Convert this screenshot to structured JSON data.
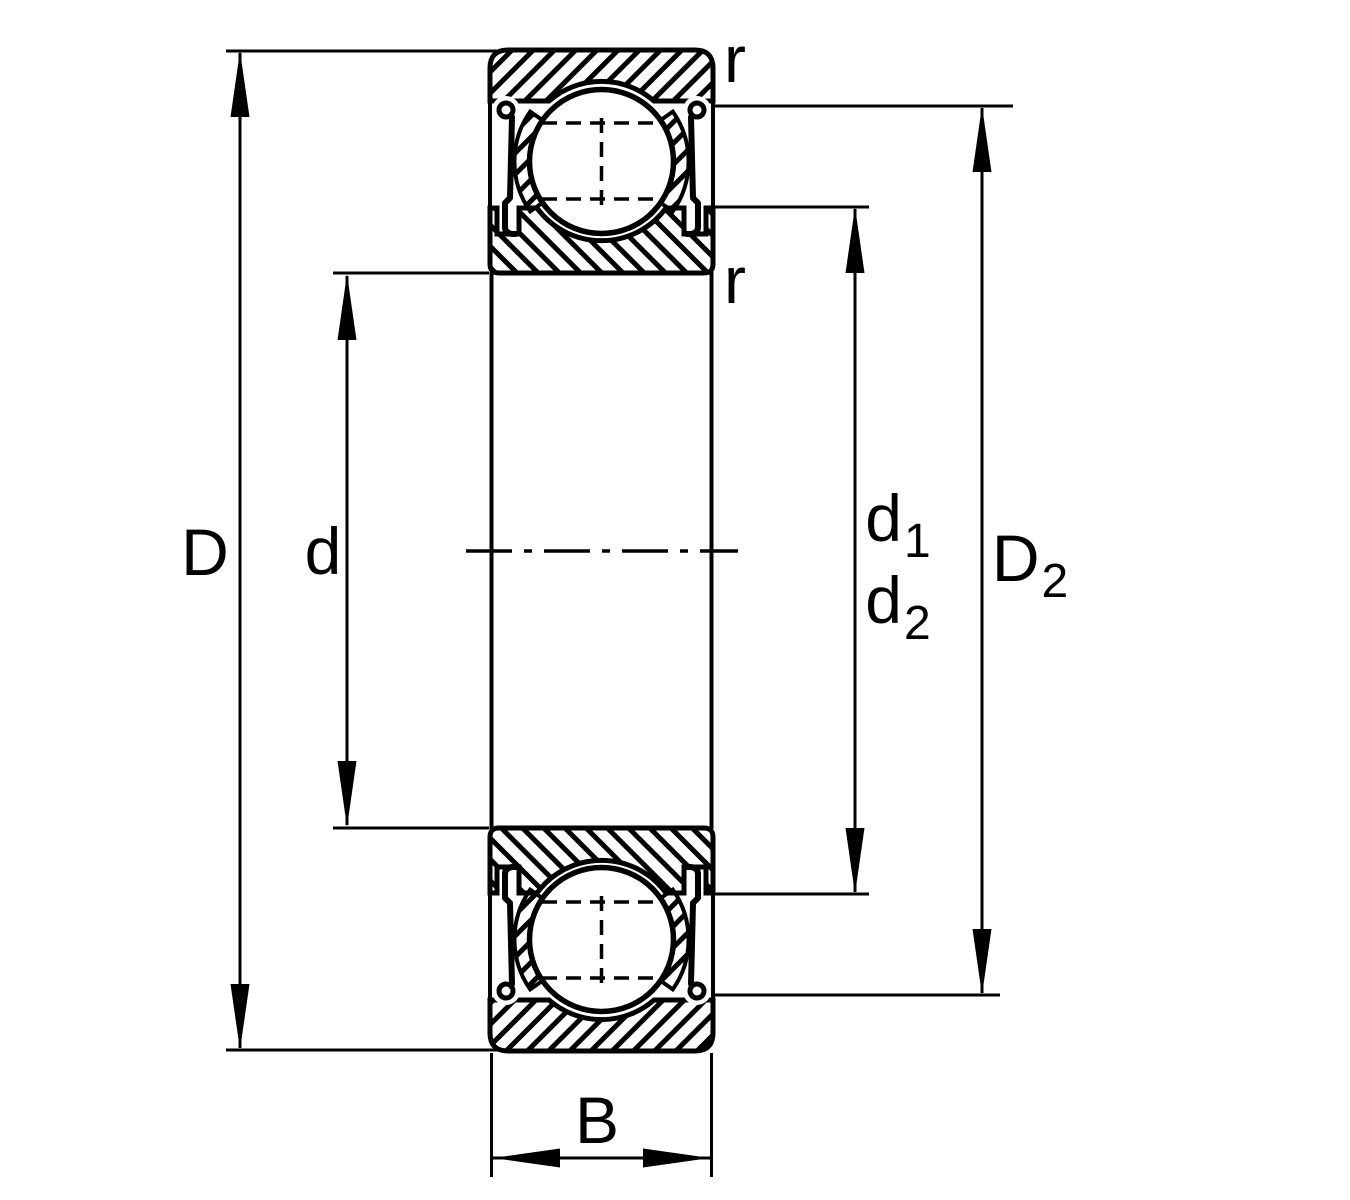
{
  "drawing": {
    "colors": {
      "background": "#ffffff",
      "lines": "#000000"
    },
    "dimension_labels": {
      "outer_diameter": {
        "base": "D",
        "sub": ""
      },
      "bore_diameter": {
        "base": "d",
        "sub": ""
      },
      "shoulder_diameter_1": {
        "base": "d",
        "sub": "1"
      },
      "shoulder_diameter_2": {
        "base": "d",
        "sub": "2"
      },
      "recess_diameter": {
        "base": "D",
        "sub": "2"
      },
      "width": {
        "base": "B",
        "sub": ""
      },
      "chamfer_radius_outer": {
        "base": "r",
        "sub": ""
      },
      "chamfer_radius_inner": {
        "base": "r",
        "sub": ""
      }
    }
  }
}
